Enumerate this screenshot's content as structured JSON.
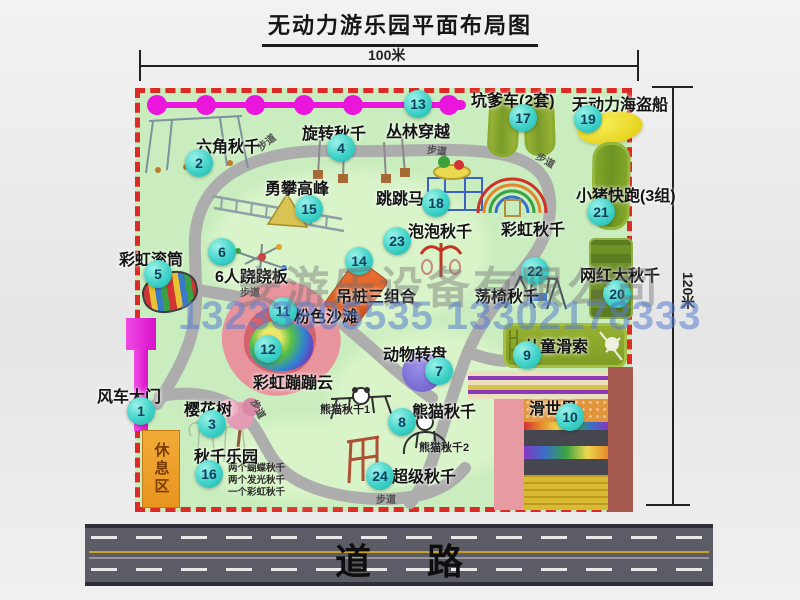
{
  "title": "无动力游乐园平面布局图",
  "dimensions": {
    "top": "100米",
    "right": "120米"
  },
  "road_label": "道  路",
  "watermark": {
    "company": "安游乐设备有限公司",
    "phones": "13233805535 13302178333"
  },
  "labels": {
    "path": "步道",
    "rest_area": "休息区",
    "rainbow_swing": "彩虹秋千",
    "panda_swing_1": "熊猫秋千1",
    "panda_swing_2": "熊猫秋千2"
  },
  "swing_park_notes": [
    "两个蝴蝶秋千",
    "两个发光秋千",
    "一个彩虹秋千"
  ],
  "attractions": [
    {
      "num": "1",
      "name": "风车大门",
      "cx": 141,
      "cy": 411,
      "lx": 97,
      "ly": 383
    },
    {
      "num": "2",
      "name": "六角秋千",
      "cx": 199,
      "cy": 163,
      "lx": 196,
      "ly": 133
    },
    {
      "num": "3",
      "name": "樱花树",
      "cx": 212,
      "cy": 424,
      "lx": 184,
      "ly": 396
    },
    {
      "num": "4",
      "name": "旋转秋千",
      "cx": 341,
      "cy": 148,
      "lx": 302,
      "ly": 120
    },
    {
      "num": "5",
      "name": "彩虹滚筒",
      "cx": 158,
      "cy": 274,
      "lx": 119,
      "ly": 246
    },
    {
      "num": "6",
      "name": "6人跷跷板",
      "cx": 222,
      "cy": 252,
      "lx": 215,
      "ly": 263
    },
    {
      "num": "7",
      "name": "动物转盘",
      "cx": 439,
      "cy": 371,
      "lx": 383,
      "ly": 341
    },
    {
      "num": "8",
      "name": "熊猫秋千",
      "cx": 402,
      "cy": 422,
      "lx": 412,
      "ly": 398
    },
    {
      "num": "9",
      "name": "儿童滑索",
      "cx": 527,
      "cy": 355,
      "lx": 524,
      "ly": 333
    },
    {
      "num": "10",
      "name": "滑世界",
      "cx": 570,
      "cy": 417,
      "lx": 529,
      "ly": 395
    },
    {
      "num": "11",
      "name": "粉色沙滩",
      "cx": 283,
      "cy": 311,
      "lx": 294,
      "ly": 303
    },
    {
      "num": "12",
      "name": "彩虹蹦蹦云",
      "cx": 268,
      "cy": 349,
      "lx": 253,
      "ly": 369
    },
    {
      "num": "13",
      "name": "丛林穿越",
      "cx": 418,
      "cy": 104,
      "lx": 386,
      "ly": 118
    },
    {
      "num": "14",
      "name": "吊桩三组合",
      "cx": 359,
      "cy": 261,
      "lx": 336,
      "ly": 283
    },
    {
      "num": "15",
      "name": "勇攀高峰",
      "cx": 309,
      "cy": 209,
      "lx": 265,
      "ly": 175
    },
    {
      "num": "16",
      "name": "秋千乐园",
      "cx": 209,
      "cy": 474,
      "lx": 194,
      "ly": 443
    },
    {
      "num": "17",
      "name": "坑爹车(2套)",
      "cx": 523,
      "cy": 118,
      "lx": 471,
      "ly": 87
    },
    {
      "num": "18",
      "name": "跳跳马",
      "cx": 436,
      "cy": 203,
      "lx": 376,
      "ly": 185
    },
    {
      "num": "19",
      "name": "无动力海盗船",
      "cx": 588,
      "cy": 119,
      "lx": 572,
      "ly": 91
    },
    {
      "num": "20",
      "name": "网红大秋千",
      "cx": 617,
      "cy": 294,
      "lx": 580,
      "ly": 262
    },
    {
      "num": "21",
      "name": "小猪快跑(3组)",
      "cx": 601,
      "cy": 212,
      "lx": 576,
      "ly": 182
    },
    {
      "num": "22",
      "name": "荡椅秋千",
      "cx": 535,
      "cy": 271,
      "lx": 475,
      "ly": 283
    },
    {
      "num": "23",
      "name": "泡泡秋千",
      "cx": 397,
      "cy": 241,
      "lx": 408,
      "ly": 218
    },
    {
      "num": "24",
      "name": "超级秋千",
      "cx": 380,
      "cy": 476,
      "lx": 392,
      "ly": 463
    }
  ],
  "path_markers": [
    {
      "x": 256,
      "y": 134,
      "r": -38
    },
    {
      "x": 427,
      "y": 142,
      "r": 6
    },
    {
      "x": 536,
      "y": 152,
      "r": 30
    },
    {
      "x": 240,
      "y": 284,
      "r": 0
    },
    {
      "x": 249,
      "y": 401,
      "r": 62
    },
    {
      "x": 376,
      "y": 491,
      "r": 0
    }
  ]
}
